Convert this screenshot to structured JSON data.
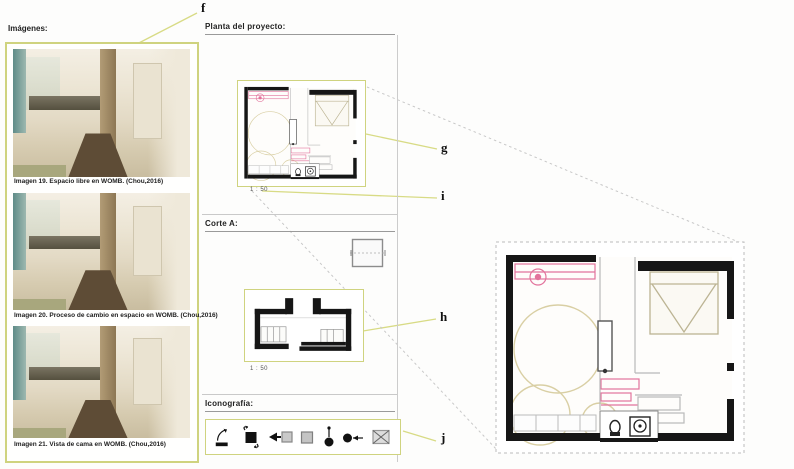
{
  "images_panel": {
    "header": "Imágenes:",
    "photos": [
      {
        "caption": "Imagen 19. Espacio libre en WOMB. (Chou,2016)"
      },
      {
        "caption": "Imagen 20. Proceso de cambio en espacio en WOMB. (Chou,2016)"
      },
      {
        "caption": "Imagen 21. Vista de cama en WOMB. (Chou,2016)"
      }
    ]
  },
  "plan_section": {
    "header": "Planta del proyecto:",
    "scale": "1 : 50"
  },
  "corte_section": {
    "header": "Corte A:",
    "scale": "1 : 50"
  },
  "icon_section": {
    "header": "Iconografía:",
    "icons": [
      "pivot-panel",
      "rotating-square",
      "slide-in",
      "static-square",
      "pivot-point",
      "moving-point",
      "crossed-square"
    ]
  },
  "callouts": {
    "f": "f",
    "g": "g",
    "h": "h",
    "i": "i",
    "j": "j"
  },
  "colors": {
    "accent_box": "#cfd37f",
    "leader_line": "#d8db85",
    "dashed_projection": "#c8c8c8",
    "plan_pink": "#e2739c",
    "plan_tan": "#d9cfa4",
    "wall_black": "#161616"
  }
}
